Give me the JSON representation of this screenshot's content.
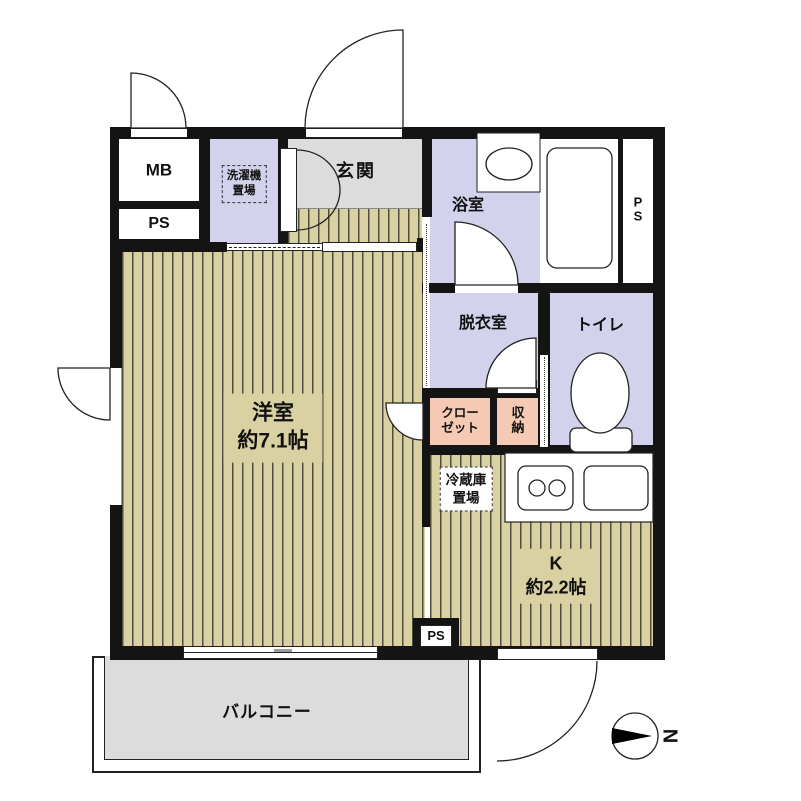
{
  "floorplan": {
    "title": "1K apartment floor plan",
    "compass": {
      "label": "N"
    },
    "rooms": {
      "meter_box": {
        "label": "MB"
      },
      "pipe_space_top": {
        "label": "PS"
      },
      "laundry": {
        "label": "洗濯機\n置場"
      },
      "entrance": {
        "label": "玄関"
      },
      "bath": {
        "label": "浴室"
      },
      "pipe_space_bath": {
        "label": "P\nS"
      },
      "dressing": {
        "label": "脱衣室"
      },
      "toilet": {
        "label": "トイレ"
      },
      "closet": {
        "label": "クロー\nゼット"
      },
      "storage": {
        "label": "収\n納"
      },
      "western_room": {
        "label": "洋室\n約7.1帖",
        "size_tatami": "約7.1帖"
      },
      "fridge_space": {
        "label": "冷蔵庫\n置場"
      },
      "kitchen": {
        "label": "K\n約2.2帖",
        "size_tatami": "約2.2帖"
      },
      "pipe_space_bottom": {
        "label": "PS"
      },
      "balcony": {
        "label": "バルコニー"
      }
    },
    "colors": {
      "wall": "#141414",
      "lavender": "#d2d2ec",
      "salmon": "#f5c9b4",
      "wood": "#dad1a2",
      "gray": "#dcdcdc",
      "line": "#222222"
    }
  }
}
